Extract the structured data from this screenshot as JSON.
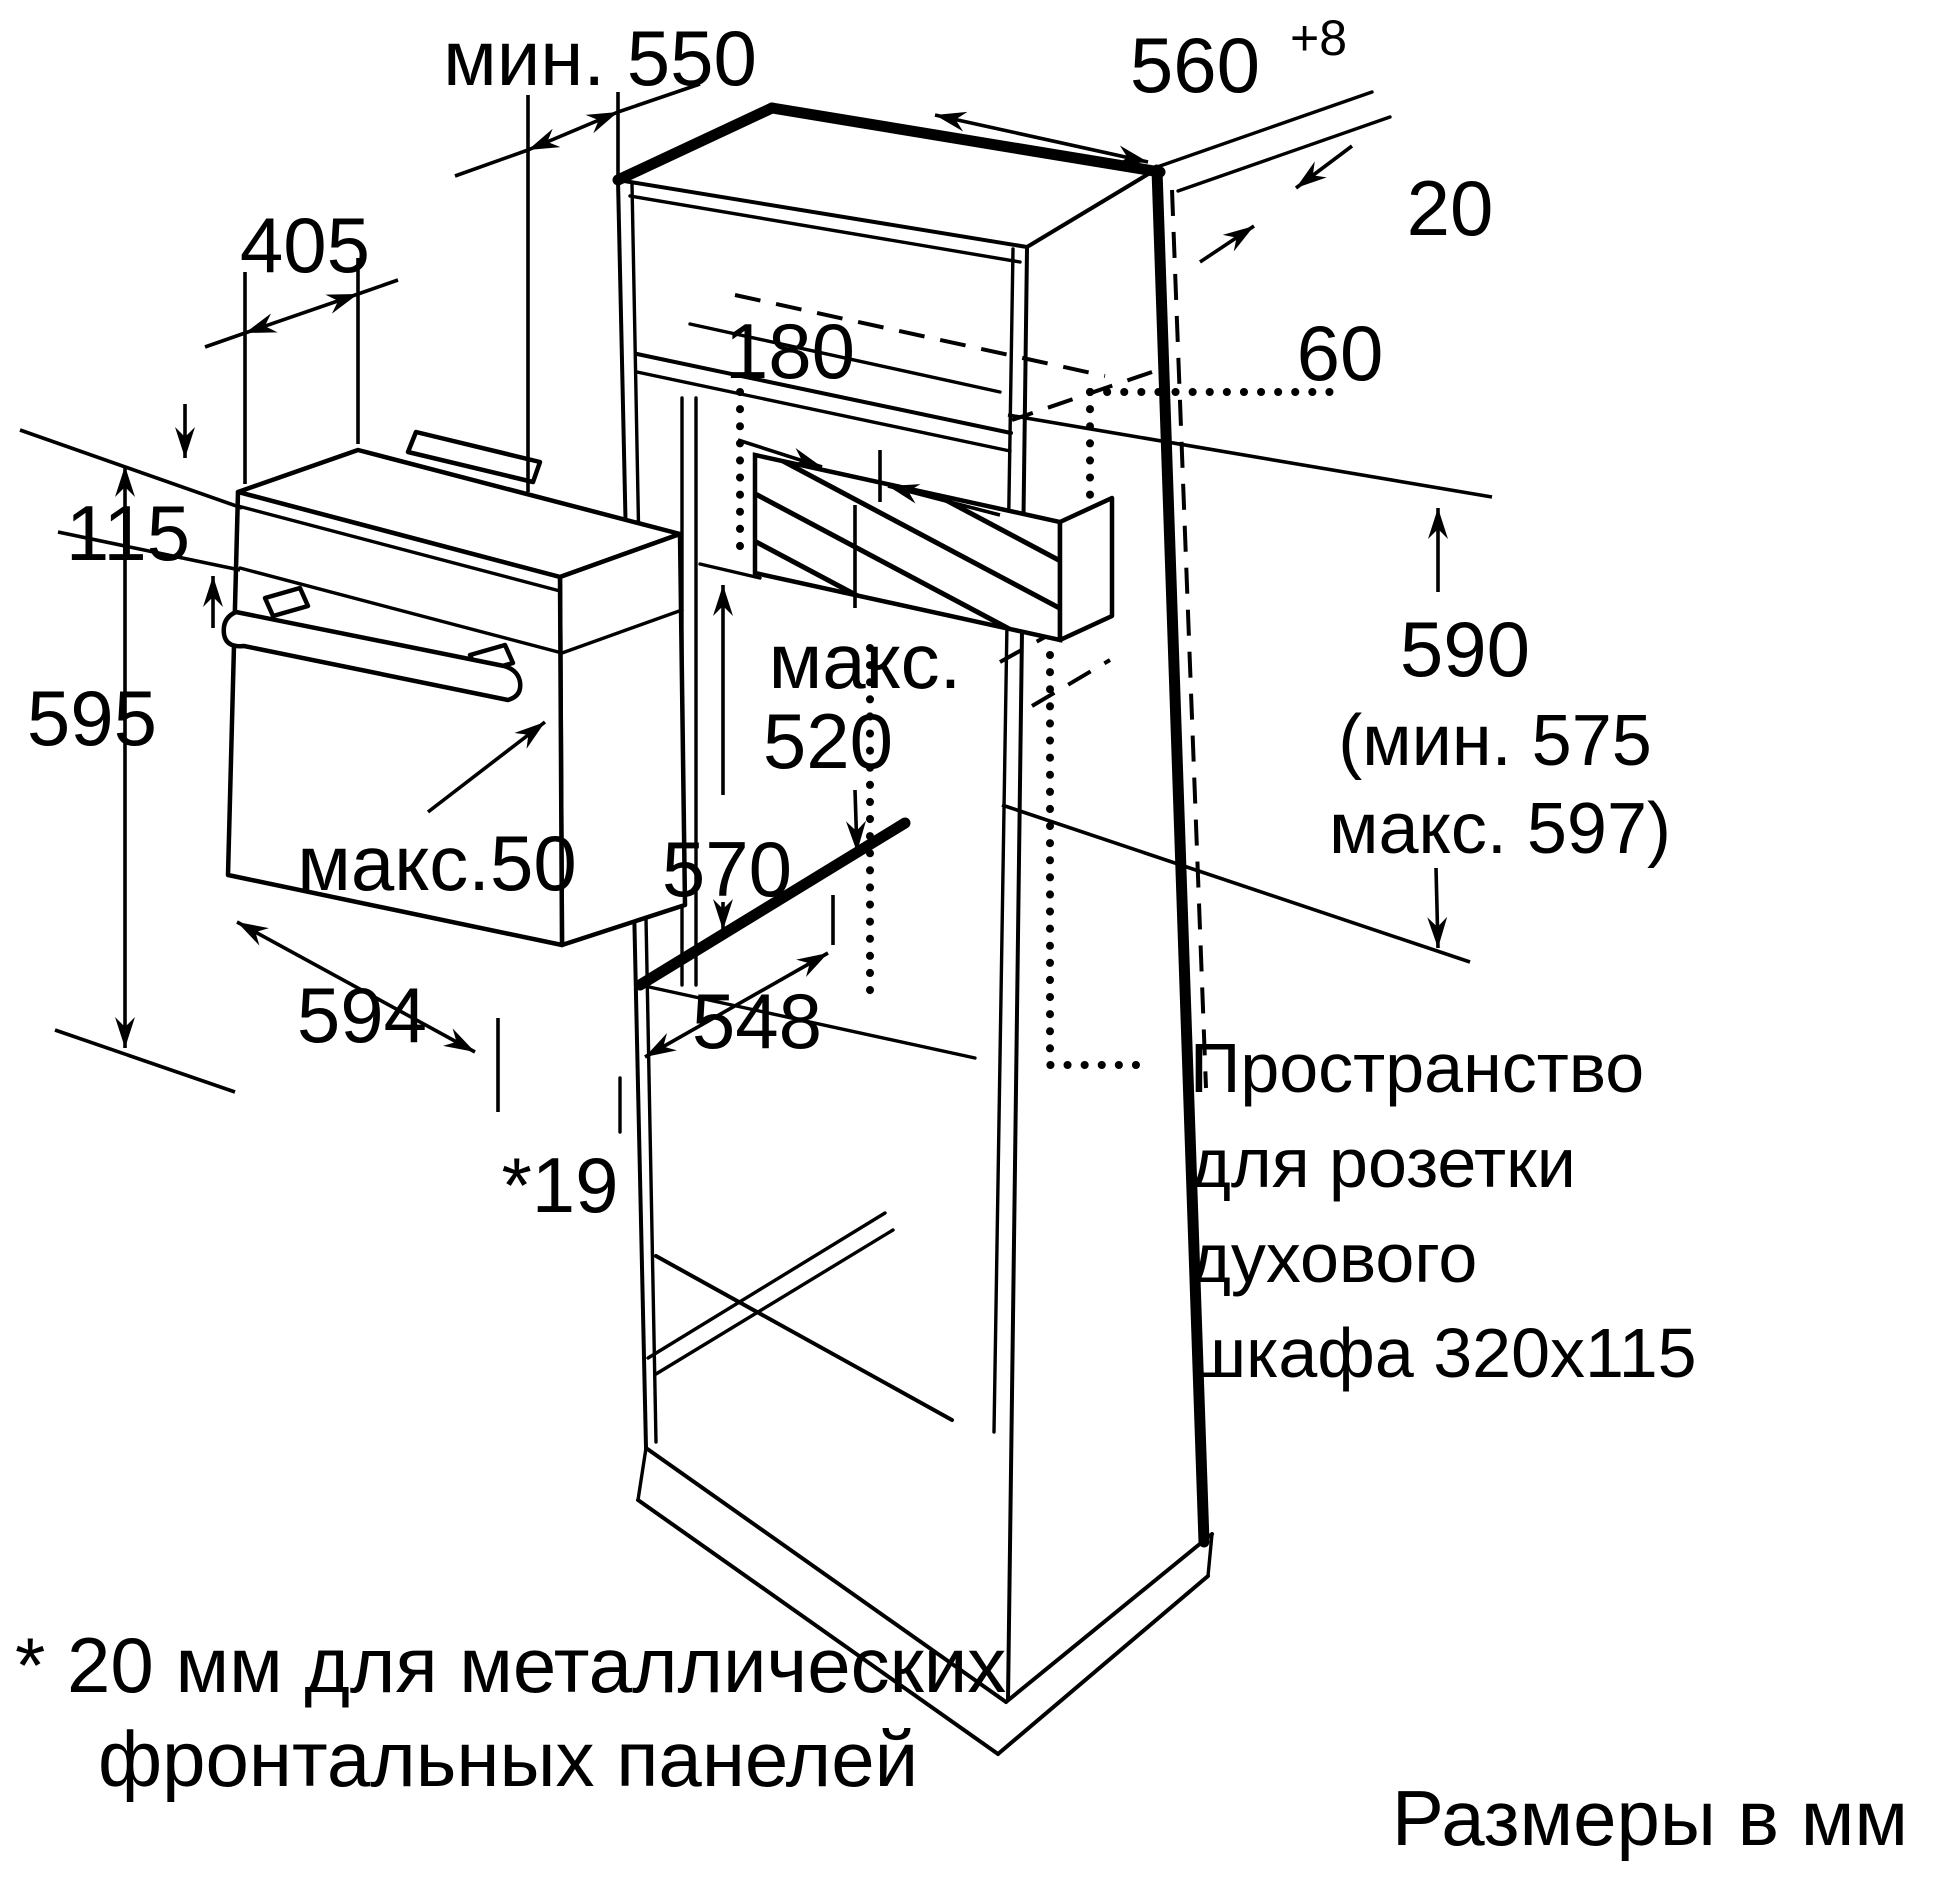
{
  "figure": {
    "type": "appliance-installation-diagram",
    "subject": "built-in oven cabinet niche",
    "line_color": "#000000",
    "background_color": "#ffffff"
  },
  "dims": {
    "min550": "мин. 550",
    "d560": "560",
    "d560sup": "+8",
    "d20": "20",
    "d405": "405",
    "d115": "115",
    "d595": "595",
    "d180": "180",
    "d60": "60",
    "maks_label": "макс.",
    "d520": "520",
    "d590": "590",
    "d590min": "(мин. 575",
    "d590max": "макс. 597)",
    "maks50": "макс.50",
    "d570": "570",
    "d594": "594",
    "d548": "548",
    "d19": "*19"
  },
  "notes": {
    "socket": {
      "l1": "Пространство",
      "l2": "для розетки",
      "l3": "духового",
      "l4": "шкафа 320x115"
    },
    "footnote": {
      "l1": "* 20 мм для металлических",
      "l2": "фронтальных панелей"
    },
    "units": "Размеры в мм"
  }
}
